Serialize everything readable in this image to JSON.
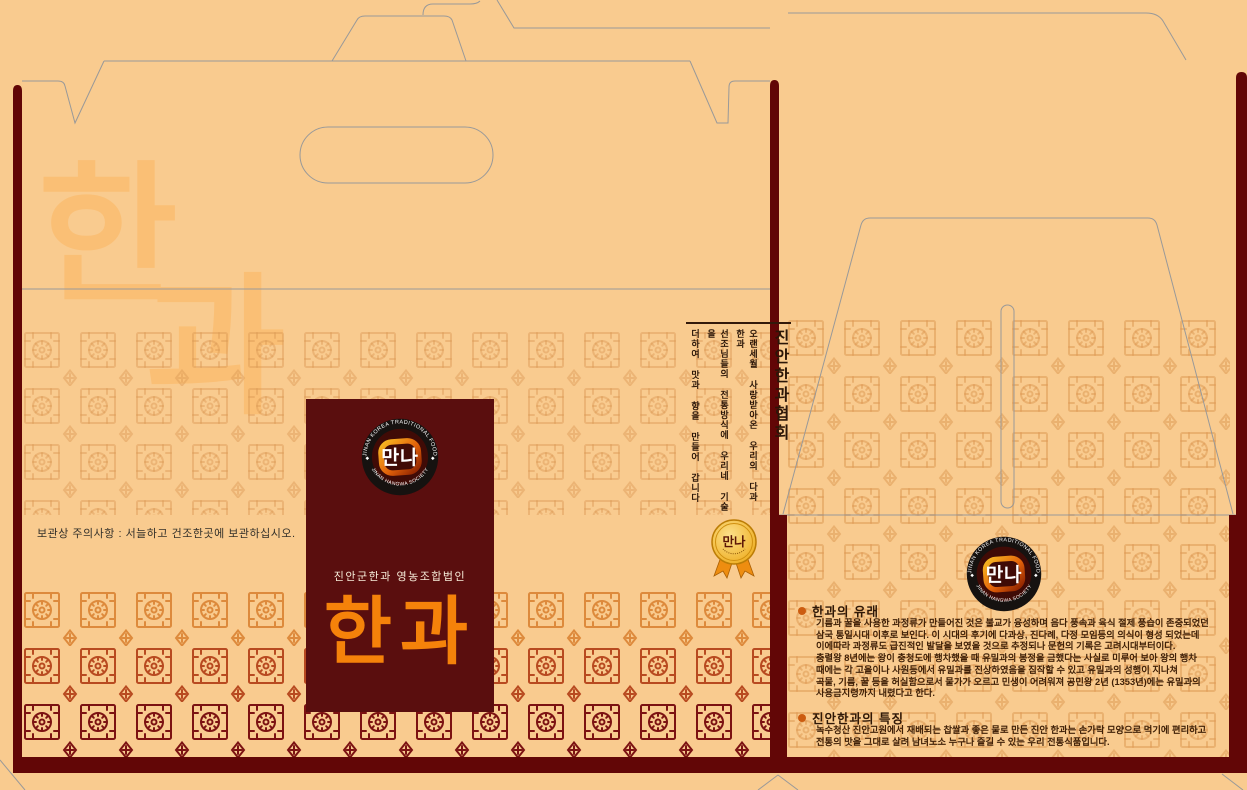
{
  "package": {
    "watermark_char_1": "한",
    "watermark_char_2": "과",
    "storage_notice": "보관상 주의사항 : 서늘하고 건조한곳에 보관하십시오.",
    "front": {
      "subtitle": "진안군한과 영농조합법인",
      "title": "한과"
    },
    "association_block": {
      "title": "진안한과협회",
      "lines": [
        "오랜세월 사랑받아온 우리의 다과 한과",
        "선조님들의 전통방식에 우리네 기술을",
        "더하여 맛과 향을 만들어 갑니다"
      ]
    },
    "logo": {
      "center_label": "만나",
      "arc_top": "JINAN KOREA TRADITIONAL FOOD",
      "arc_bottom": "JINAN HANGWA SOCIETY",
      "separator": "◆"
    },
    "medal": {
      "label": "만나"
    },
    "info": {
      "sections": [
        {
          "title": "한과의 유래",
          "body": [
            "기름과 꿀을 사용한 과정류가 만들어진 것은 불교가 융성하며 음다 풍속과 육식 절제 풍습이 존중되었던",
            "삼국 통일시대 이후로 보인다. 이 시대의 후기에 다과상, 진다례, 다정 모임등의 의식이 형성 되었는데",
            "이에따라 과정류도 급진적인 발달을 보였을 것으로 추정되나 문헌의 기록은 고려시대부터이다.",
            "충렬왕 8년에는 왕이 충청도에 행차했을 때 유밀과의 봉정을 금했다는 사실로 미루어 보아 왕의 행차",
            "때에는 각 고을이나 사원등에서 유밀과를 진상하였음을 짐작할 수 있고 유밀과의 성행이 지나쳐",
            "곡물, 기름, 꿀 등을 허실함으로서 물가가 오르고 민생이 어려워져 공민왕 2년 (1353년)에는 유밀과의",
            "사용금지령까지 내렸다고 한다."
          ]
        },
        {
          "title": "진안한과의 특징",
          "body": [
            "녹수청산 진안고원에서 재배되는 찹쌀과 좋은 물로 만든 진안 한과는 손가락 모양으로 먹기에 편리하고",
            "전통의 맛을 그대로 살려 남녀노소 누구나 즐길 수 있는 우리 전통식품입니다."
          ]
        }
      ]
    },
    "colors": {
      "background": "#f9cb8f",
      "maroon_bar": "#620606",
      "panel_maroon": "#5a0e0e",
      "title_orange": "#f5820a",
      "watermark": "#fabf75",
      "pattern_orange": "#dd8a3c",
      "pattern_red": "#b84a20",
      "pattern_maroon": "#7c1212",
      "medal_gold": "#f2b42a",
      "dieline_gray": "#999999"
    }
  }
}
